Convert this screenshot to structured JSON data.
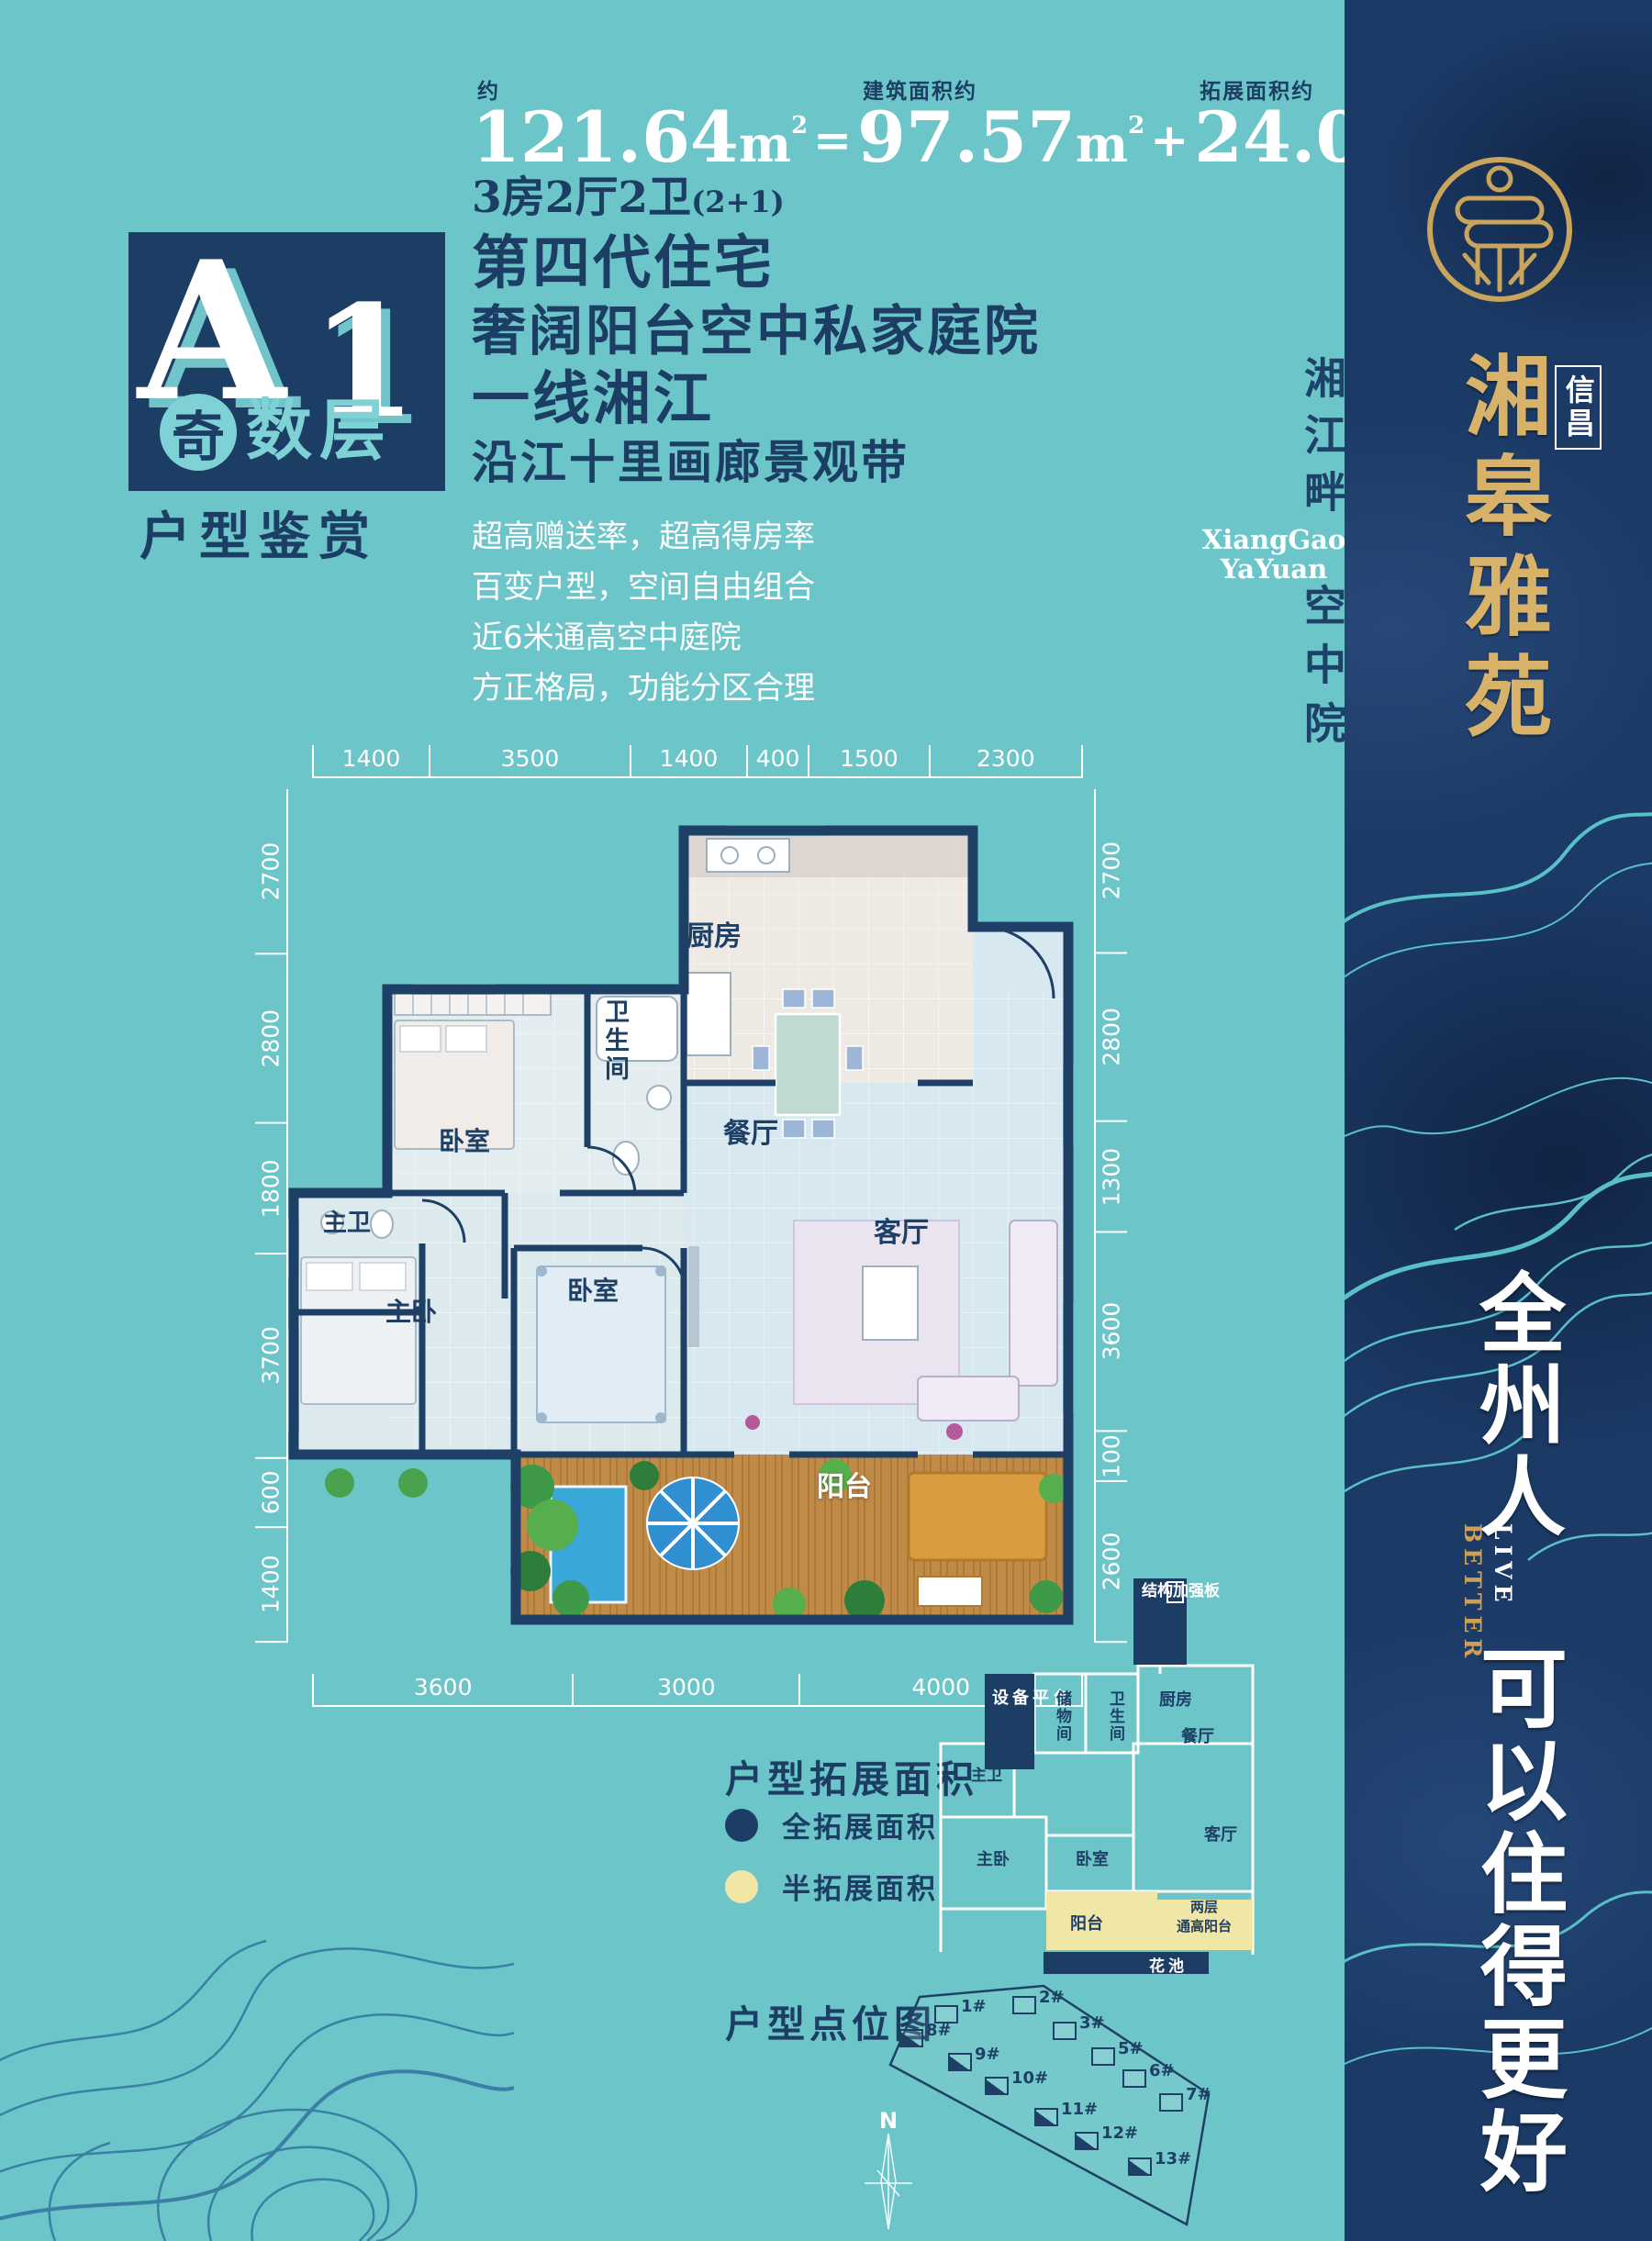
{
  "colors": {
    "teal_bg": "#6cc5c8",
    "navy": "#1d3e64",
    "gold": "#d9b26a",
    "yellow": "#f0e6a6",
    "white": "#ffffff"
  },
  "header": {
    "approx_label": "约",
    "total_value": "121.64",
    "built_label": "建筑面积约",
    "built_value": "97.57",
    "ext_label": "拓展面积约",
    "ext_value": "24.07",
    "unit": "m",
    "sup": "2",
    "equals": "=",
    "plus": "+",
    "layout_line": "3房2厅2卫",
    "layout_suffix": "(2+1)"
  },
  "badge": {
    "letter": "A",
    "number": "1",
    "circle_char": "奇",
    "row_chars": "数层",
    "caption": "户型鉴赏"
  },
  "headlines": [
    "第四代住宅",
    "奢阔阳台空中私家庭院",
    "一线湘江",
    "沿江十里画廊景观带"
  ],
  "bullets": [
    "超高赠送率，超高得房率",
    "百变户型，空间自由组合",
    "近6米通高空中庭院",
    "方正格局，功能分区合理"
  ],
  "plan": {
    "dims_top": [
      "1400",
      "3500",
      "1400",
      "400",
      "1500",
      "2300"
    ],
    "dims_left": [
      "2700",
      "2800",
      "1800",
      "3700",
      "600",
      "1400"
    ],
    "dims_right": [
      "2700",
      "2800",
      "1300",
      "3600",
      "100",
      "2600"
    ],
    "dims_bottom": [
      "3600",
      "3000",
      "4000"
    ],
    "rooms": {
      "kitchen": "厨房",
      "bath": "卫生间",
      "dining": "餐厅",
      "bedroom1": "卧室",
      "master_bath": "主卫",
      "master_bedroom": "主卧",
      "bedroom2": "卧室",
      "living": "客厅",
      "balcony": "阳台"
    }
  },
  "expansion": {
    "title": "户型拓展面积",
    "legend": [
      {
        "label": "全拓展面积",
        "color": "#1d3e64"
      },
      {
        "label": "半拓展面积",
        "color": "#f0e6a6"
      }
    ],
    "labels": {
      "structure": "结构加强板",
      "equipment": "设备平台",
      "storage": "储物间",
      "bath": "卫生间",
      "kitchen": "厨房",
      "dining": "餐厅",
      "master_bath": "主卫",
      "master_bedroom": "主卧",
      "bedroom": "卧室",
      "living": "客厅",
      "balcony": "阳台",
      "tall_balcony_1": "两层",
      "tall_balcony_2": "通高阳台",
      "flower": "花池"
    }
  },
  "sitemap": {
    "title": "户型点位图",
    "compass": "N",
    "buildings": [
      {
        "label": "1#",
        "hl": false
      },
      {
        "label": "2#",
        "hl": false
      },
      {
        "label": "3#",
        "hl": false
      },
      {
        "label": "5#",
        "hl": false
      },
      {
        "label": "6#",
        "hl": false
      },
      {
        "label": "7#",
        "hl": false
      },
      {
        "label": "8#",
        "hl": true
      },
      {
        "label": "9#",
        "hl": true
      },
      {
        "label": "10#",
        "hl": true
      },
      {
        "label": "11#",
        "hl": true
      },
      {
        "label": "12#",
        "hl": true
      },
      {
        "label": "13#",
        "hl": true
      }
    ]
  },
  "sidebar": {
    "sub_brand": "信昌",
    "brand": "湘皋雅苑",
    "caption_top": "湘江畔",
    "latin1": "XiangGao",
    "latin2": "YaYuan",
    "caption_bottom": "空中院",
    "slogan_top": "全州人",
    "live": "LIVE",
    "better": "BETTER",
    "slogan_bottom": "可以住得更好"
  }
}
